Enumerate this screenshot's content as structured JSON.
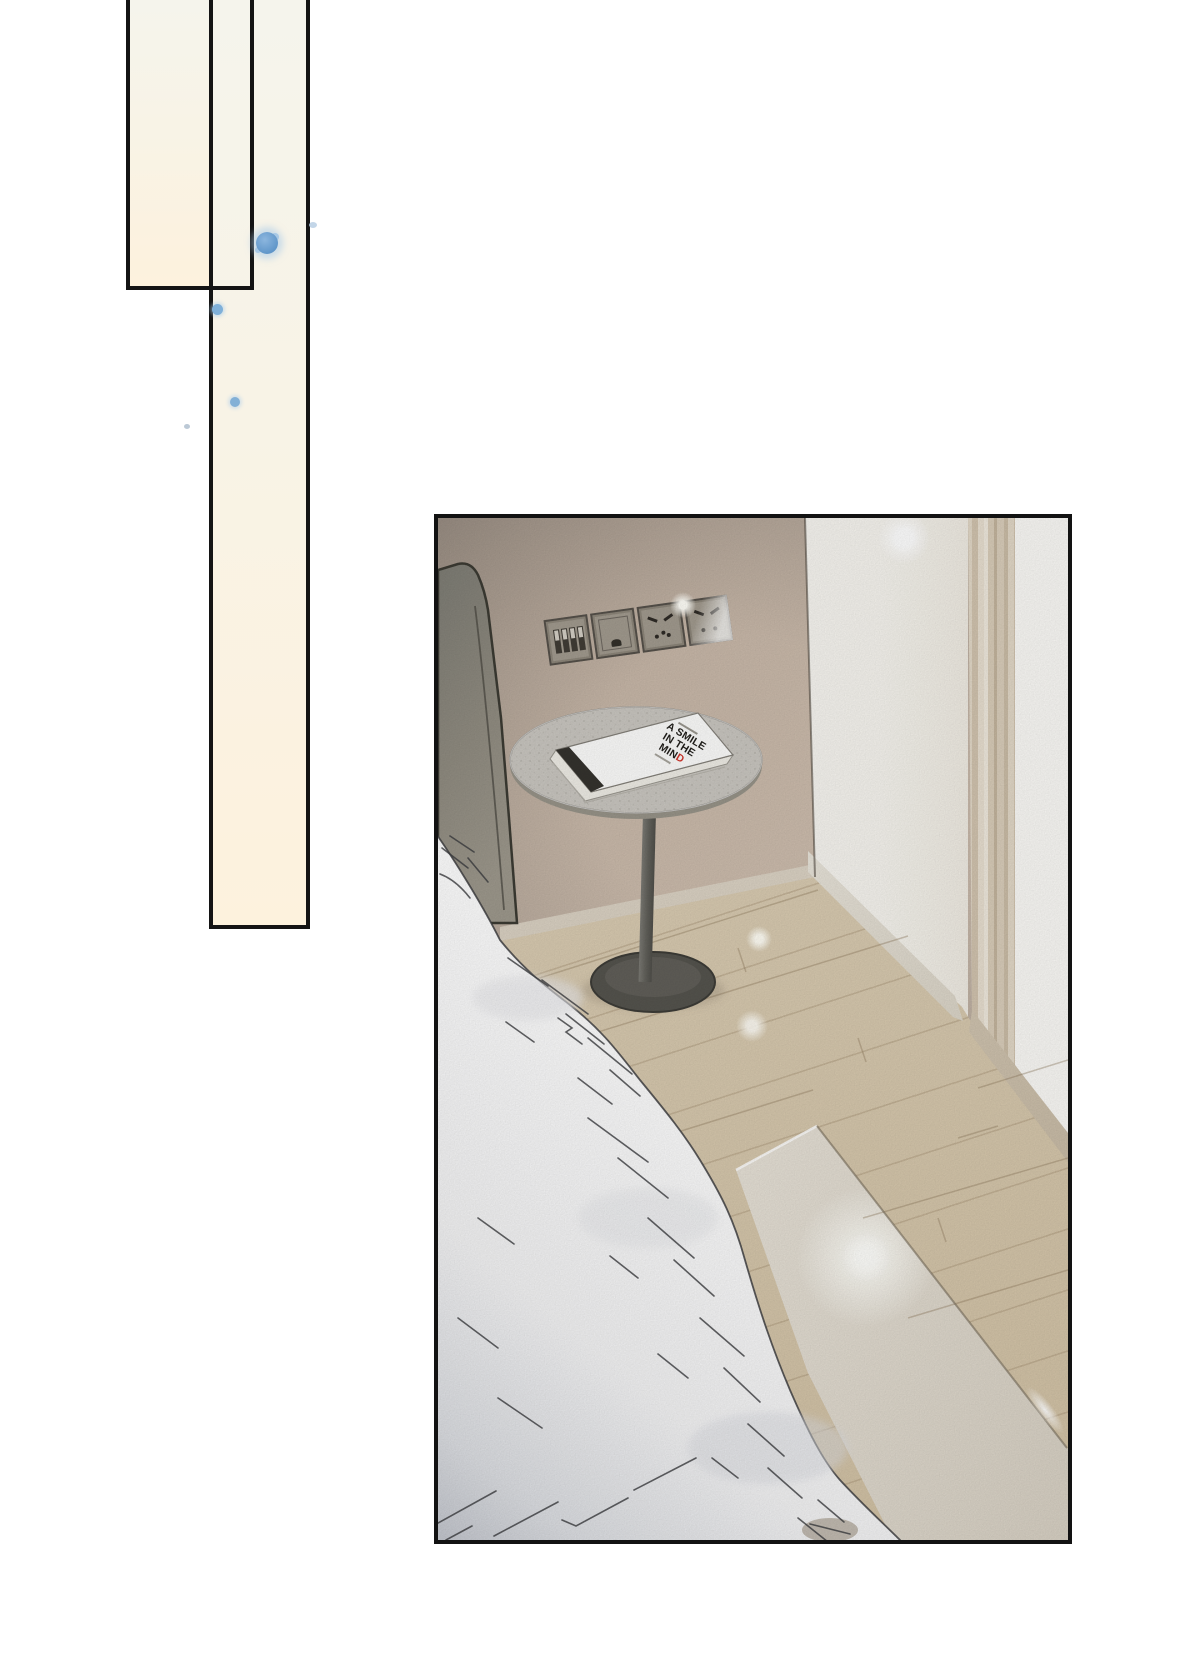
{
  "page": {
    "kind": "comic-page",
    "background": "#ffffff",
    "panel_border_color": "#121212",
    "decor_fill_color": "#f8f3e6",
    "ink_splash_color": "#5d94c8"
  },
  "scene": {
    "wall_color": "#b5a99d",
    "floor_color": "#d8cab0",
    "bedding_color": "#fdfdfd",
    "table_top_color": "#c9c6c0",
    "table_base_color": "#56554f"
  },
  "book": {
    "title_line1": "A SMILE",
    "title_line2": "IN THE",
    "title_line3_black": "MIN",
    "title_line3_red": "D",
    "accent_red": "#d4352b",
    "cover_color": "#fdfdfc"
  }
}
